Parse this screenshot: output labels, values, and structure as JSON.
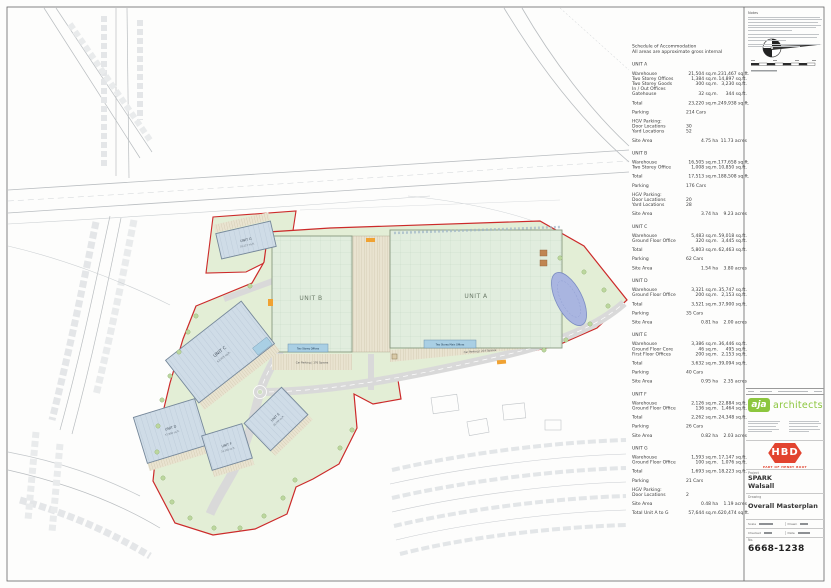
{
  "plan": {
    "units": {
      "a": "UNIT A",
      "b": "UNIT B",
      "c": "UNIT C",
      "d": "UNIT D",
      "e": "UNIT E",
      "f": "UNIT F",
      "g": "UNIT G"
    },
    "unit_areas": {
      "c": "62,463 sq.ft.",
      "d": "37,900 sq.ft.",
      "e": "39,094 sq.ft.",
      "f": "24,348 sq.ft.",
      "g": "18,223 sq.ft."
    },
    "labels": {
      "offices_b": "Two Storey Offices",
      "offices_a": "Two Storey Main Offices",
      "car_parking_b": "Car Parking | 176 Spaces",
      "car_parking_a": "Car Parking | 214 Spaces"
    },
    "colors": {
      "boundary": "#cc2a2a",
      "landscape": "#e3eed6",
      "roof_green": "#e1edde",
      "roof_blue": "#cfdce7",
      "office": "#a9cfe4",
      "parking": "#e9e3d0",
      "pond": "#a9b5e0",
      "road": "#d9d9d9",
      "accent_orange": "#f0a232"
    }
  },
  "schedule": {
    "title": "Schedule of Accommodation",
    "subtitle": "All areas are approximate gross internal",
    "sections": [
      {
        "heading": "UNIT A",
        "groups": [
          [
            [
              "Warehouse",
              "21,504 sq.m.",
              "231,467 sq.ft."
            ],
            [
              "Two Storey Offices",
              "1,384 sq.m.",
              "14,897 sq.ft."
            ],
            [
              "Two Storey Goods",
              "300 sq.m.",
              "3,230 sq.ft."
            ],
            [
              "In / Out Offices",
              "",
              ""
            ],
            [
              "Gatehouse",
              "32 sq.m.",
              "344 sq.ft."
            ]
          ],
          [
            [
              "Total",
              "23,220 sq.m.",
              "249,938 sq.ft."
            ]
          ],
          [
            [
              "Parking",
              "214 Cars",
              ""
            ]
          ],
          [
            [
              "HGV Parking:",
              "",
              ""
            ],
            [
              "Door Locations",
              "30",
              ""
            ],
            [
              "Yard Locations",
              "52",
              ""
            ]
          ],
          [
            [
              "Site Area",
              "4.75 ha",
              "11.73 acres"
            ]
          ]
        ]
      },
      {
        "heading": "UNIT B",
        "groups": [
          [
            [
              "Warehouse",
              "16,505 sq.m.",
              "177,658 sq.ft."
            ],
            [
              "Two Storey Office",
              "1,008 sq.m.",
              "10,850 sq.ft."
            ]
          ],
          [
            [
              "Total",
              "17,513 sq.m.",
              "188,508 sq.ft."
            ]
          ],
          [
            [
              "Parking",
              "176 Cars",
              ""
            ]
          ],
          [
            [
              "HGV Parking:",
              "",
              ""
            ],
            [
              "Door Locations",
              "20",
              ""
            ],
            [
              "Yard Locations",
              "28",
              ""
            ]
          ],
          [
            [
              "Site Area",
              "3.74 ha",
              "9.23 acres"
            ]
          ]
        ]
      },
      {
        "heading": "UNIT C",
        "groups": [
          [
            [
              "Warehouse",
              "5,483 sq.m.",
              "59,018 sq.ft."
            ],
            [
              "Ground Floor Office",
              "320 sq.m.",
              "3,445 sq.ft."
            ]
          ],
          [
            [
              "Total",
              "5,803 sq.m.",
              "62,463 sq.ft."
            ]
          ],
          [
            [
              "Parking",
              "62 Cars",
              ""
            ]
          ],
          [
            [
              "Site Area",
              "1.54 ha",
              "3.80 acres"
            ]
          ]
        ]
      },
      {
        "heading": "UNIT D",
        "groups": [
          [
            [
              "Warehouse",
              "3,321 sq.m.",
              "35,747 sq.ft."
            ],
            [
              "Ground Floor Office",
              "200 sq.m.",
              "2,153 sq.ft."
            ]
          ],
          [
            [
              "Total",
              "3,521 sq.m.",
              "37,900 sq.ft."
            ]
          ],
          [
            [
              "Parking",
              "35 Cars",
              ""
            ]
          ],
          [
            [
              "Site Area",
              "0.81 ha",
              "2.00 acres"
            ]
          ]
        ]
      },
      {
        "heading": "UNIT E",
        "groups": [
          [
            [
              "Warehouse",
              "3,386 sq.m.",
              "36,446 sq.ft."
            ],
            [
              "Ground Floor Core",
              "46 sq.m.",
              "495 sq.ft."
            ],
            [
              "First Floor Offices",
              "200 sq.m.",
              "2,153 sq.ft."
            ]
          ],
          [
            [
              "Total",
              "3,632 sq.m.",
              "39,094 sq.ft."
            ]
          ],
          [
            [
              "Parking",
              "40 Cars",
              ""
            ]
          ],
          [
            [
              "Site Area",
              "0.95 ha",
              "2.35 acres"
            ]
          ]
        ]
      },
      {
        "heading": "UNIT F",
        "groups": [
          [
            [
              "Warehouse",
              "2,126 sq.m.",
              "22,884 sq.ft."
            ],
            [
              "Ground Floor Office",
              "136 sq.m.",
              "1,464 sq.ft."
            ]
          ],
          [
            [
              "Total",
              "2,262 sq.m.",
              "24,348 sq.ft."
            ]
          ],
          [
            [
              "Parking",
              "26 Cars",
              ""
            ]
          ],
          [
            [
              "Site Area",
              "0.82 ha",
              "2.03 acres"
            ]
          ]
        ]
      },
      {
        "heading": "UNIT G",
        "groups": [
          [
            [
              "Warehouse",
              "1,593 sq.m.",
              "17,147 sq.ft."
            ],
            [
              "Ground Floor Office",
              "100 sq.m.",
              "1,076 sq.ft."
            ]
          ],
          [
            [
              "Total",
              "1,693 sq.m.",
              "18,223 sq.ft."
            ]
          ],
          [
            [
              "Parking",
              "21 Cars",
              ""
            ]
          ],
          [
            [
              "HGV Parking:",
              "",
              ""
            ],
            [
              "Door Locations",
              "2",
              ""
            ]
          ],
          [
            [
              "Site Area",
              "0.48 ha",
              "1.19 acres"
            ]
          ],
          [
            [
              "Total Unit A to G",
              "57,644 sq.m.",
              "620,474 sq.ft."
            ]
          ]
        ]
      }
    ]
  },
  "titleblock": {
    "notes_label": "Notes",
    "architect": {
      "logo_text": "aja",
      "name": "architects",
      "brand_color": "#8cc63e"
    },
    "developer": {
      "logo_text": "HBD",
      "tagline": "PART OF HENRY BOOT",
      "brand_color": "#e2432f"
    },
    "project_label": "Project",
    "project_line1": "SPARK",
    "project_line2": "Walsall",
    "drawing_label": "Drawing",
    "drawing_title": "Overall Masterplan",
    "fields": {
      "scale_label": "Scale",
      "drawn_label": "Drawn",
      "checked_label": "Checked",
      "date_label": "Date",
      "number_label": "No.",
      "number": "6668-1238"
    }
  }
}
